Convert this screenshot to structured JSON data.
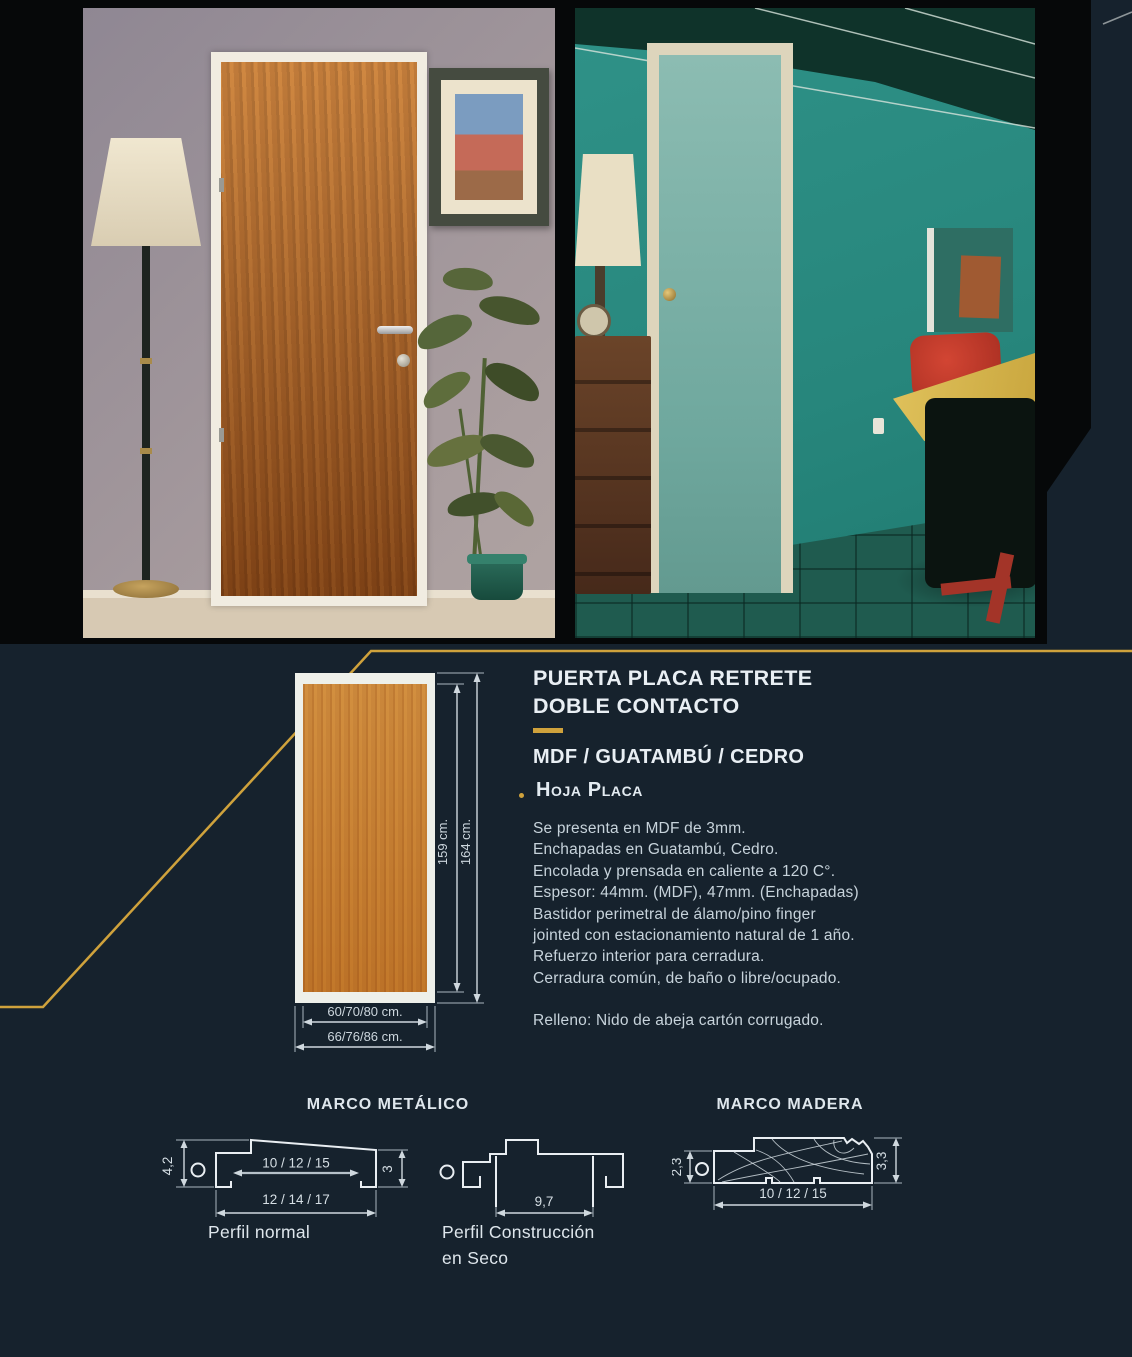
{
  "colors": {
    "accent_gold": "#cfa23c",
    "background_navy": "#16222d",
    "photo_band_black": "#060809",
    "diagram_line": "#e9eef2"
  },
  "product": {
    "title_line1": "PUERTA PLACA RETRETE",
    "title_line2": "DOBLE CONTACTO",
    "materials": "MDF / GUATAMBÚ / CEDRO",
    "section_heading": "Hoja Placa",
    "specs": [
      "Se presenta en MDF de 3mm.",
      "Enchapadas en Guatambú, Cedro.",
      "Encolada y prensada en caliente a 120 C°.",
      "Espesor: 44mm. (MDF), 47mm. (Enchapadas)",
      "Bastidor perimetral de álamo/pino finger",
      "jointed con estacionamiento natural de 1 año.",
      "Refuerzo interior para cerradura.",
      "Cerradura común, de baño o libre/ocupado."
    ],
    "filling": "Relleno: Nido de abeja cartón corrugado."
  },
  "door_diagram": {
    "height_leaf": "159 cm.",
    "height_frame": "164 cm.",
    "width_leaf": "60/70/80 cm.",
    "width_frame": "66/76/86 cm."
  },
  "frames": {
    "metal_title": "MARCO METÁLICO",
    "wood_title": "MARCO MADERA",
    "perfil_normal": {
      "label": "Perfil normal",
      "height": "4,2",
      "right_height": "3",
      "inner_width": "10 / 12 / 15",
      "outer_width": "12 / 14 / 17"
    },
    "perfil_seco": {
      "label_line1": "Perfil Construcción",
      "label_line2": "en Seco",
      "width": "9,7"
    },
    "perfil_madera": {
      "left_height": "2,3",
      "right_height": "3,3",
      "width": "10 / 12 / 15"
    }
  }
}
